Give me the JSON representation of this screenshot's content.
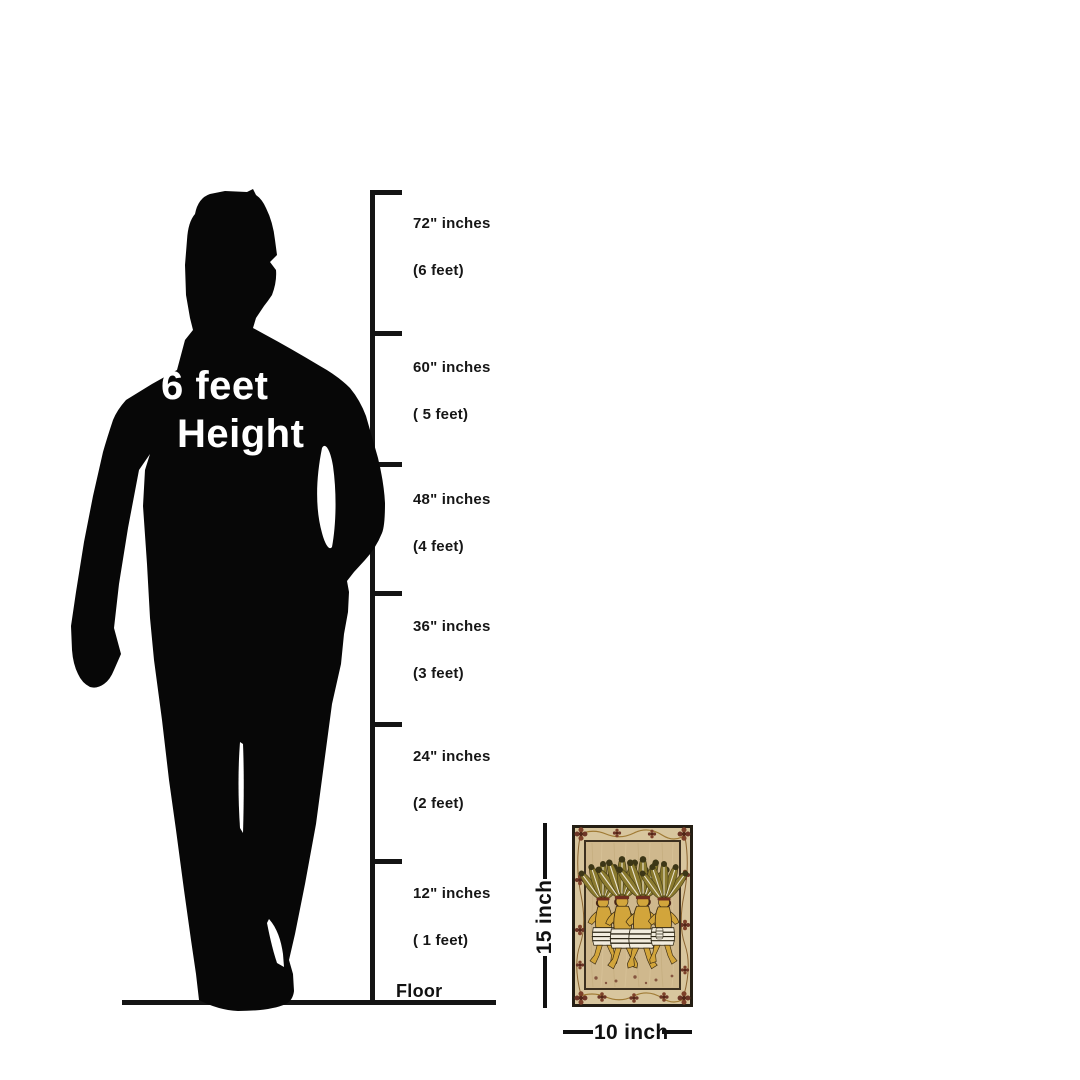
{
  "canvas": {
    "width": 1080,
    "height": 1080,
    "background": "#ffffff"
  },
  "figure": {
    "label_line1": "6 feet",
    "label_line2": "Height",
    "silhouette_color": "#070707",
    "text_color": "#ffffff"
  },
  "ruler": {
    "line_color": "#141414",
    "ticks": [
      {
        "inches": "72\" inches",
        "feet": "(6 feet)"
      },
      {
        "inches": "60\" inches",
        "feet": "( 5 feet)"
      },
      {
        "inches": "48\" inches",
        "feet": "(4 feet)"
      },
      {
        "inches": "36\" inches",
        "feet": "(3 feet)"
      },
      {
        "inches": "24\" inches",
        "feet": "(2 feet)"
      },
      {
        "inches": "12\" inches",
        "feet": "( 1 feet)"
      }
    ],
    "floor_label": "Floor"
  },
  "artwork": {
    "description": "framed tribal folk painting of four dancers with feather headdresses and striped skirts",
    "height_label": "15 inch",
    "width_label": "10 inch",
    "palette": {
      "frame": "#241e14",
      "border_background": "#d8c69e",
      "floral": "#6d3526",
      "vine": "#a07b35",
      "panel": "#cfb88d",
      "figures": "#d2a53b",
      "feathers": "#8a7a2e",
      "feather_tips": "#3c3616",
      "skirts": "#f2ecdd",
      "outline": "#3a2d1b"
    }
  }
}
